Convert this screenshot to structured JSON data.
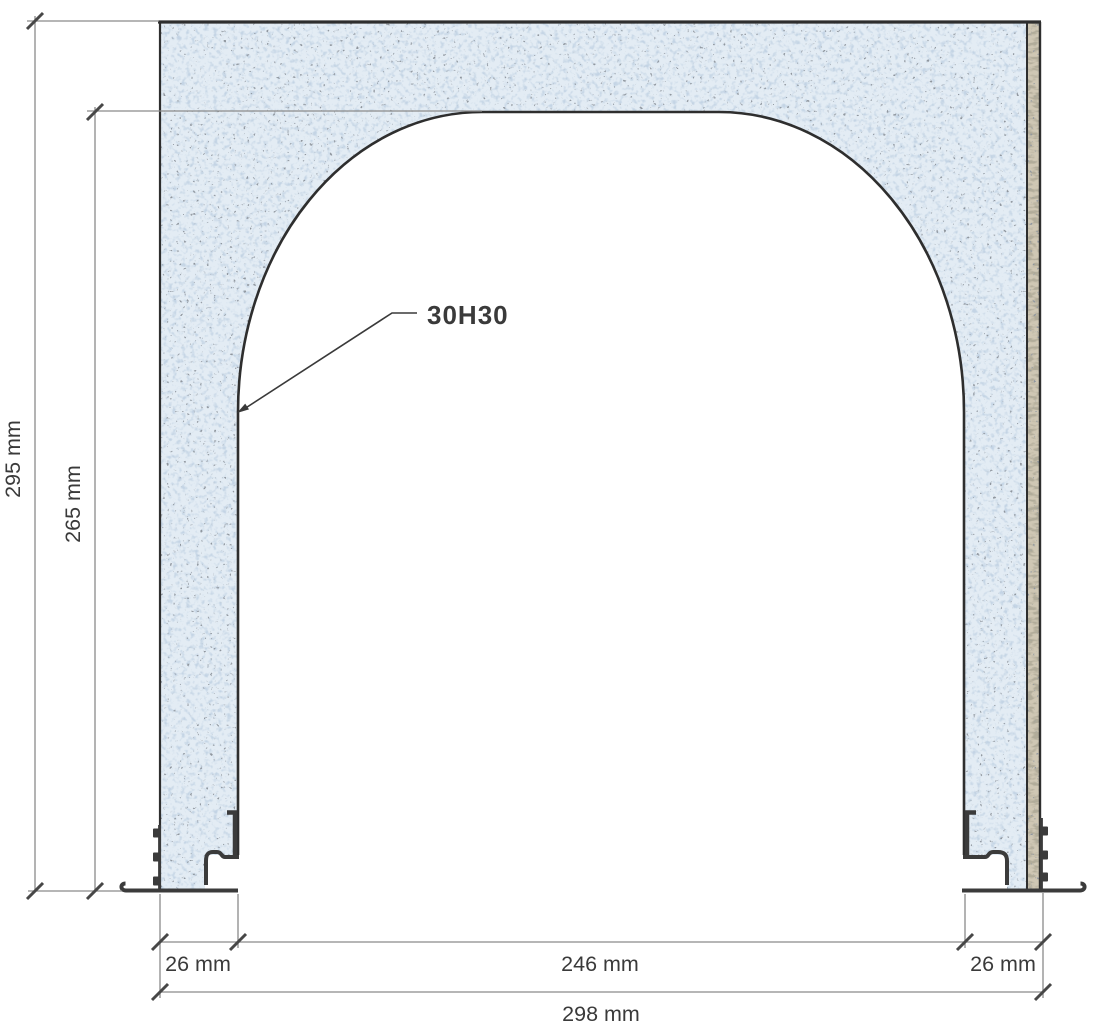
{
  "title": "Arch cross-section technical drawing",
  "annotation": "30H30",
  "dimensions": {
    "height_total": "295 mm",
    "height_opening": "265 mm",
    "leg_left": "26 mm",
    "opening_width": "246 mm",
    "leg_right": "26 mm",
    "total_width": "298 mm"
  },
  "colors": {
    "concrete": "#e3ecf4",
    "plaster": "#cfc7b4",
    "outline": "#2e2e2e",
    "dim_line": "#8a8a8a",
    "dim_text": "#3a3a3a",
    "profile": "#3b3b3b",
    "tick": "#474747",
    "background": "#ffffff"
  }
}
